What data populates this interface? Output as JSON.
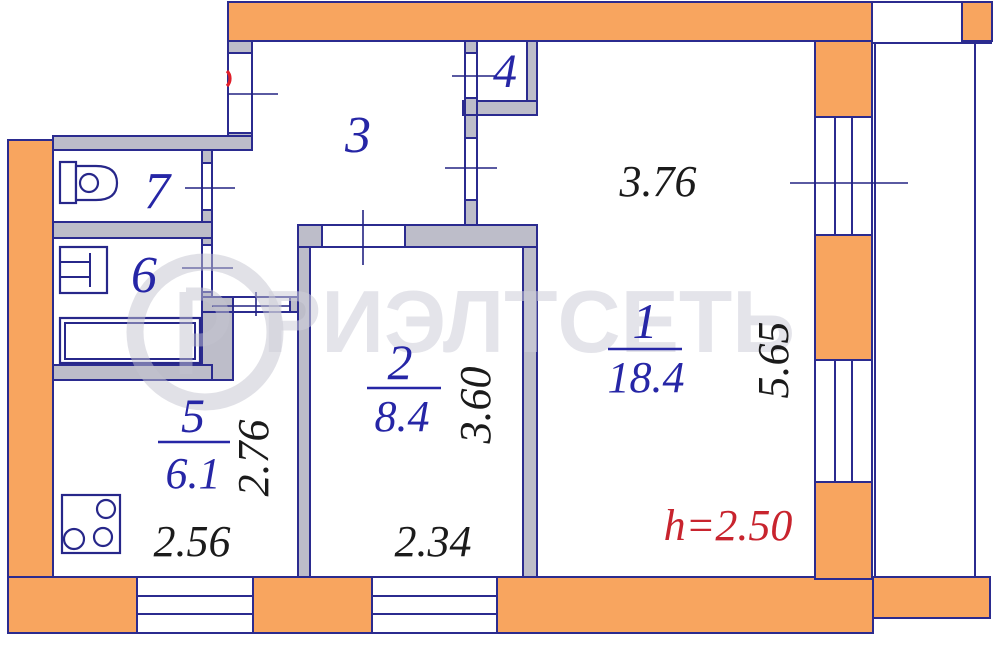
{
  "watermark": {
    "text": "РИЭЛТСЕТЬ",
    "logo_letter": "Р"
  },
  "rooms": [
    {
      "number": "1",
      "area": "18.4"
    },
    {
      "number": "2",
      "area": "8.4"
    },
    {
      "number": "3"
    },
    {
      "number": "4"
    },
    {
      "number": "5",
      "area": "6.1"
    },
    {
      "number": "6"
    },
    {
      "number": "7"
    }
  ],
  "dimensions": {
    "room1_width": "3.76",
    "room1_depth": "5.65",
    "room2_depth": "3.60",
    "room2_width": "2.34",
    "kitchen_depth": "2.76",
    "kitchen_width": "2.56",
    "ceiling_height": "h=2.50"
  },
  "colors": {
    "outer_wall": "#f8a55f",
    "inner_wall": "#bdbdc9",
    "outline": "#2b2b8f",
    "room_label": "#2626a6",
    "dimension_text": "#1b1b1b",
    "height_text": "#c8242e",
    "watermark": "#cfcfda"
  }
}
